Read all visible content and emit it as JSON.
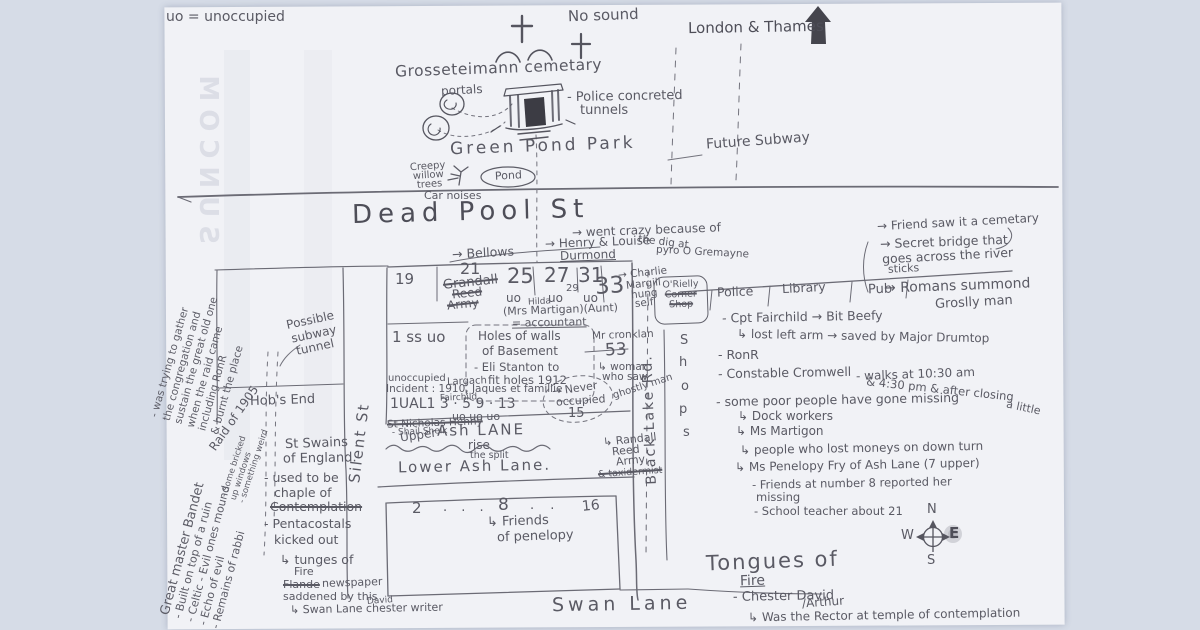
{
  "watermark": "SUNCOM",
  "legend": "uo = unoccupied",
  "london": "London & Thames",
  "cemetery": {
    "name": "Grosseteimann cemetary",
    "no_sound": "No sound",
    "portals": "portals",
    "tunnels1": "- Police concreted",
    "tunnels2": "tunnels"
  },
  "park": {
    "name": "Green Pond Park",
    "creepy": [
      "Creepy",
      "willow",
      "trees"
    ],
    "pond": "Pond",
    "car_noises": "Car noises",
    "future_subway": "Future Subway"
  },
  "streets": {
    "dead_pool": "Dead Pool St",
    "silent": "Silent St",
    "black_lake": "Black Lake Rd.",
    "upper_small": "Upper",
    "ash_lane": "Ash LANE",
    "rise": "rise",
    "split": "the split",
    "lower_ash": "Lower Ash Lane.",
    "swan": "Swan Lane",
    "shops": [
      "S",
      "h",
      "o",
      "p",
      "s"
    ]
  },
  "row1": {
    "bellows": "→ Bellows",
    "henry1": "→ Henry & Louise",
    "henry2": "Durmond",
    "crazy1": "→ went crazy because of",
    "crazy2": "the dig at",
    "crazy3": "pyro O Gremayne",
    "n19": "19",
    "n21": "21",
    "struck": [
      "Grandall",
      "Reed",
      "Army"
    ],
    "n25": "25",
    "n27": "27",
    "n29": "29",
    "n31": "31",
    "n33": "33",
    "uo": [
      "uo",
      "uo",
      "uo"
    ],
    "hilda": "Hilda",
    "martigan": "(Mrs Martigan)(Aunt)",
    "accountant": "= accountant",
    "charlie": [
      "→ Charlie",
      "Margill",
      "hung",
      "self"
    ]
  },
  "block": {
    "ss": "1 ss uo",
    "basement": [
      "Holes of walls",
      "of Basement",
      "- Eli Stanton to",
      "fit holes 1912"
    ],
    "cronklan": "Mr cronklan",
    "n53": "53",
    "woman": [
      "↳ woman",
      "who saw",
      "ghostly man"
    ],
    "incident1": "unoccupied",
    "largach": "Largach",
    "incident2": "Incident : 1910, Jaques et famillie",
    "fairchild": "Fairchild",
    "numrow": "1UAL1   3  ·   5     9   ·  13",
    "uorow": "uo       uo       uo",
    "nicholas": "St Nicholas Henny",
    "sheik": "- Shail Sheik",
    "never": [
      "→ Never",
      "occupied",
      "15"
    ],
    "randall": [
      "↳ Randall",
      "Reed",
      "Army",
      "& taxidermist"
    ]
  },
  "left": {
    "possible": [
      "Possible",
      "subway",
      "tunnel"
    ],
    "hobs_end": "Hob's End"
  },
  "shop": {
    "line1": "O'Rielly",
    "line2": "Corner",
    "line3": "Shop"
  },
  "buildings": [
    "Police",
    "Library",
    "Pub"
  ],
  "right_notes": [
    "→ Friend saw it a cemetary",
    "→ Secret bridge that",
    "goes across the river",
    "sticks",
    "→ Romans summond",
    "Groslly man"
  ],
  "police_notes": [
    "- Cpt Fairchild → Bit Beefy",
    "↳ lost left arm → saved by Major Drumtop",
    "- RonR",
    "- Constable Cromwell",
    "- walks at 10:30 am",
    "& 4:30 pm & after closing",
    "- some poor people have gone missing",
    "a little",
    "↳ Dock workers",
    "↳ Ms Martigon",
    "↳ people who lost moneys on down turn",
    "↳ Ms Penelopy Fry of Ash Lane (7 upper)",
    "- Friends at number 8 reported her",
    "missing",
    "- School teacher about 21"
  ],
  "bottom_block": {
    "n2": "2",
    "dots1": "·  ·  ·",
    "n8": "8",
    "dots2": "·  ·",
    "n16": "16",
    "friends1": "↳ Friends",
    "friends2": "of penelopy"
  },
  "left_notes": {
    "swains": [
      "St Swains",
      "of England.",
      "- used to be",
      "chaple of",
      "Contemplation",
      "- Pentacostals",
      "kicked out",
      "↳ tunges of",
      "Fire"
    ],
    "flande": "Flande",
    "newspaper": "newspaper",
    "saddened": "saddened by this",
    "david": "David",
    "swan_writer": "↳ Swan Lane chester writer"
  },
  "rotated": {
    "master": [
      "Great master Bandet",
      "- Built on top of a ruin",
      "- Celtic - Evil ones mound",
      "- Echo of evil",
      "- Remains of rabbi"
    ],
    "gather": [
      "- was trying to gather",
      "the congregation and",
      "sustain the great old one",
      "when the raid came",
      "including RonR",
      "& burnt the place"
    ],
    "raid": "Raid of 1905",
    "bricked": [
      "- Some bricked",
      "up windows",
      "- something weird"
    ]
  },
  "tongues": {
    "t1": "Tongues of",
    "t2": "Fire",
    "t3": "- Chester David",
    "t4": "/Arthur",
    "t5": "↳ Was the Rector at temple of contemplation"
  },
  "compass": {
    "n": "N",
    "w": "W",
    "e": "E",
    "s": "S"
  }
}
